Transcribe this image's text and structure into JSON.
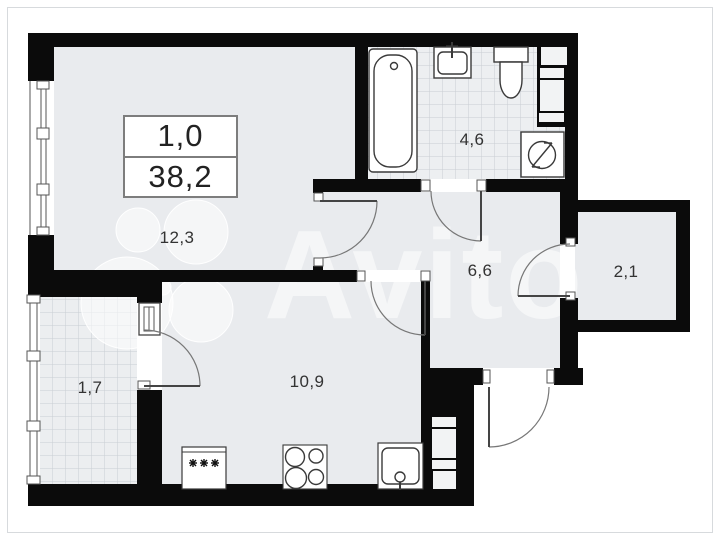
{
  "floor_plan": {
    "unit": {
      "rooms_count": "1,0",
      "total_area": "38,2"
    },
    "rooms": [
      {
        "name": "living-room",
        "area": "12,3"
      },
      {
        "name": "bathroom",
        "area": "4,6"
      },
      {
        "name": "hallway",
        "area": "6,6"
      },
      {
        "name": "storage",
        "area": "2,1"
      },
      {
        "name": "balcony",
        "area": "1,7"
      },
      {
        "name": "kitchen",
        "area": "10,9"
      }
    ],
    "watermark": {
      "text": "Avito"
    }
  }
}
